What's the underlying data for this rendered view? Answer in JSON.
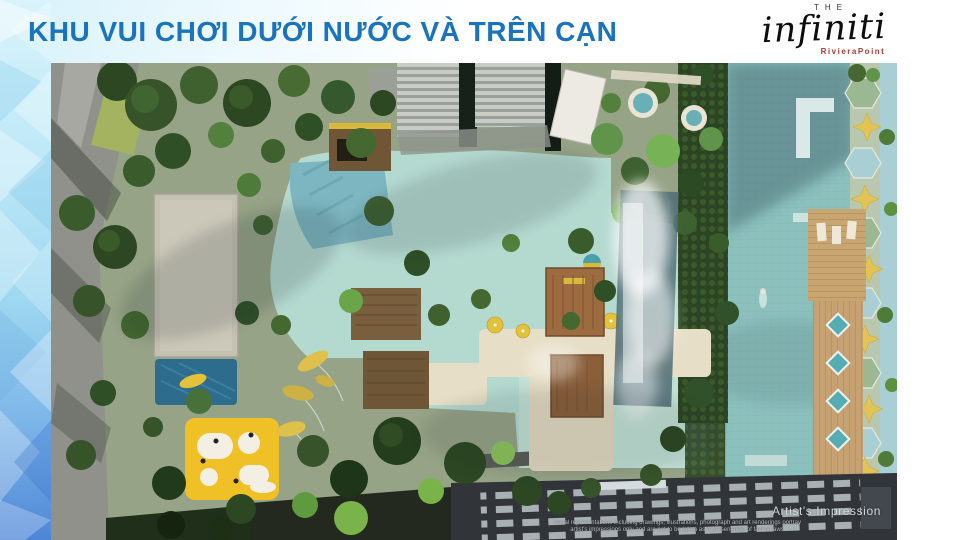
{
  "header": {
    "title": "KHU VUI CHƠI DƯỚI NƯỚC VÀ TRÊN CẠN"
  },
  "logo": {
    "the": "THE",
    "brand": "infiniti",
    "developer": "RivieraPoint"
  },
  "render": {
    "caption": "Artist's Impression",
    "disclaimer_line1": "Visual representations including drawings, illustrations, photograph and art renderings portray",
    "disclaimer_line2": "artist's impressions only and are not to be taken as representation of fact or laws"
  },
  "colors": {
    "title_blue": "#1a73be",
    "developer_red": "#a83a30",
    "accent_strip_top": "#d9f3fb",
    "accent_strip_bottom": "#4e86d6",
    "lagoon_pool": "#b4d9cf",
    "lap_pool": "#8cc0bd",
    "play_yellow": "#f0c126",
    "deck_beige": "#e6dec6",
    "roof_dark": "#31353a"
  }
}
